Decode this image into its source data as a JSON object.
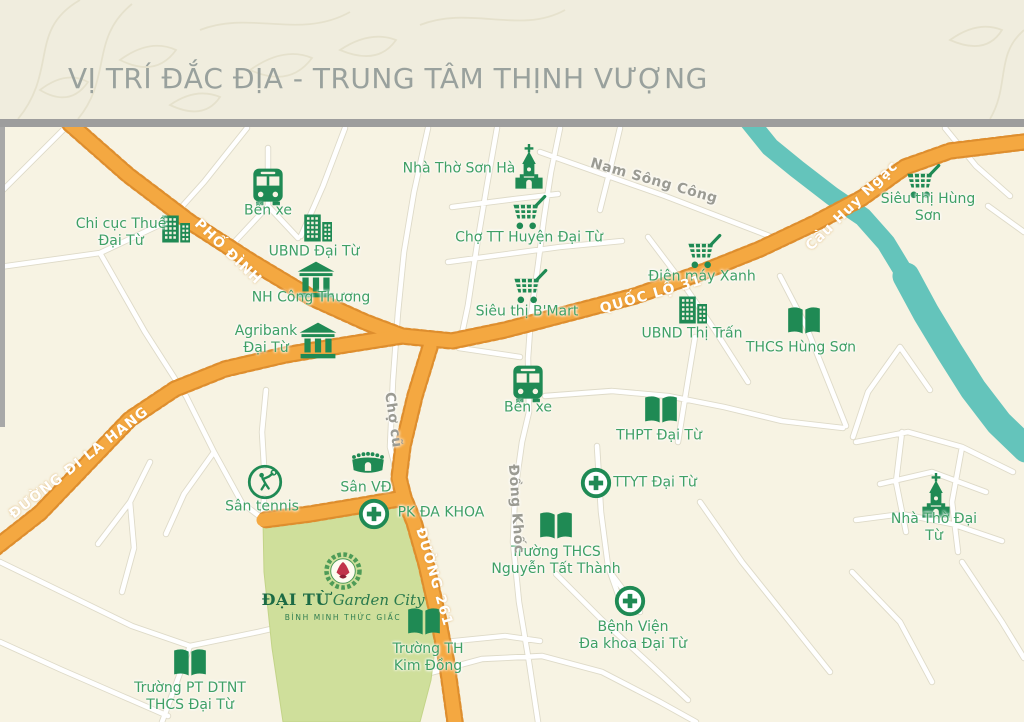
{
  "header": {
    "title": "VỊ TRÍ ĐẮC ĐỊA - TRUNG TÂM THỊNH VƯỢNG"
  },
  "colors": {
    "title_gray": "#99A19D",
    "road_orange": "#F4A841",
    "road_edge_orange": "#DE8E2E",
    "river_teal": "#64C4BB",
    "project_green": "#CFDF9B",
    "icon_green": "#1F8A54",
    "label_green": "#3FA066",
    "street_label_gray": "#9B9B93"
  },
  "map": {
    "pois": [
      {
        "id": "chi-cuc-thue",
        "icon": "building",
        "x": 175,
        "y": 229,
        "label": "Chi cục Thuế\nĐại Từ",
        "lx": 121,
        "ly": 233
      },
      {
        "id": "ben-xe-north",
        "icon": "bus",
        "x": 268,
        "y": 186,
        "label": "Bến xe",
        "lx": 268,
        "ly": 211
      },
      {
        "id": "ubnd-dai-tu",
        "icon": "building",
        "x": 317,
        "y": 228,
        "label": "UBND Đại Từ",
        "lx": 314,
        "ly": 252
      },
      {
        "id": "nha-tho-son-ha",
        "icon": "church",
        "x": 529,
        "y": 167,
        "label": "Nhà Thờ Sơn Hà",
        "lx": 459,
        "ly": 169
      },
      {
        "id": "cho-tt-huyen",
        "icon": "cart",
        "x": 529,
        "y": 213,
        "label": "Chợ TT Huyện Đại Từ",
        "lx": 529,
        "ly": 238
      },
      {
        "id": "sieu-thi-hung-son",
        "icon": "cart",
        "x": 923,
        "y": 182,
        "label": "Siêu thị Hùng Sơn",
        "lx": 928,
        "ly": 208
      },
      {
        "id": "nh-cong-thuong",
        "icon": "bank",
        "x": 316,
        "y": 279,
        "label": "NH Công Thương",
        "lx": 311,
        "ly": 298
      },
      {
        "id": "sieu-thi-bmart",
        "icon": "cart",
        "x": 530,
        "y": 287,
        "label": "Siêu thị B'Mart",
        "lx": 527,
        "ly": 312
      },
      {
        "id": "dien-may-xanh",
        "icon": "cart",
        "x": 704,
        "y": 252,
        "label": "Điện máy Xanh",
        "lx": 702,
        "ly": 277
      },
      {
        "id": "ubnd-thi-tran",
        "icon": "building",
        "x": 692,
        "y": 310,
        "label": "UBND Thị Trấn",
        "lx": 692,
        "ly": 334
      },
      {
        "id": "thcs-hung-son",
        "icon": "book",
        "x": 804,
        "y": 321,
        "label": "THCS Hùng Sơn",
        "lx": 801,
        "ly": 348
      },
      {
        "id": "agribank",
        "icon": "bank",
        "x": 318,
        "y": 340,
        "label": "Agribank\nĐại Từ",
        "lx": 266,
        "ly": 340
      },
      {
        "id": "ben-xe-center",
        "icon": "bus",
        "x": 528,
        "y": 383,
        "label": "Bến xe",
        "lx": 528,
        "ly": 408
      },
      {
        "id": "thpt-dai-tu",
        "icon": "book",
        "x": 661,
        "y": 410,
        "label": "THPT Đại Từ",
        "lx": 659,
        "ly": 436
      },
      {
        "id": "san-vd",
        "icon": "stadium",
        "x": 368,
        "y": 464,
        "label": "Sân VĐ",
        "lx": 366,
        "ly": 488
      },
      {
        "id": "san-tennis",
        "icon": "tennis",
        "x": 265,
        "y": 482,
        "label": "Sân tennis",
        "lx": 262,
        "ly": 507
      },
      {
        "id": "pk-da-khoa",
        "icon": "medcross",
        "x": 374,
        "y": 514,
        "label": "PK ĐA KHOA",
        "lx": 441,
        "ly": 513
      },
      {
        "id": "ttyt-dai-tu",
        "icon": "medcross",
        "x": 596,
        "y": 483,
        "label": "TTYT Đại Từ",
        "lx": 655,
        "ly": 483
      },
      {
        "id": "thcs-nguyen-tat-thanh",
        "icon": "book",
        "x": 556,
        "y": 526,
        "label": "Trường THCS\nNguyễn Tất Thành",
        "lx": 556,
        "ly": 561
      },
      {
        "id": "nha-tho-dai-tu",
        "icon": "church",
        "x": 936,
        "y": 496,
        "label": "Nhà Thờ Đại Từ",
        "lx": 934,
        "ly": 528
      },
      {
        "id": "th-kim-dong",
        "icon": "book",
        "x": 424,
        "y": 622,
        "label": "Trường TH\nKim Đồng",
        "lx": 428,
        "ly": 658
      },
      {
        "id": "benh-vien-da-khoa",
        "icon": "medcross",
        "x": 630,
        "y": 601,
        "label": "Bệnh Viện\nĐa khoa Đại Từ",
        "lx": 633,
        "ly": 636
      },
      {
        "id": "pt-dtnt-thcs",
        "icon": "book",
        "x": 190,
        "y": 663,
        "label": "Trường PT DTNT\nTHCS Đại Từ",
        "lx": 190,
        "ly": 697
      }
    ],
    "road_labels": [
      {
        "id": "pho-dinh",
        "text": "PHỐ ĐÌNH",
        "x": 228,
        "y": 252,
        "rot": 44,
        "style": "highway"
      },
      {
        "id": "quoc-lo-31",
        "text": "QUỐC LỘ 31",
        "x": 651,
        "y": 295,
        "rot": -16,
        "style": "highway"
      },
      {
        "id": "cau-huy-ngac",
        "text": "Cầu Huy Ngạc",
        "x": 852,
        "y": 206,
        "rot": -44,
        "style": "highway"
      },
      {
        "id": "duong-di-la-hang",
        "text": "ĐƯỜNG ĐI LA HANG",
        "x": 79,
        "y": 463,
        "rot": -38,
        "style": "highway"
      },
      {
        "id": "duong-261",
        "text": "ĐƯỜNG 261",
        "x": 434,
        "y": 577,
        "rot": 74,
        "style": "highway"
      },
      {
        "id": "nam-song-cong",
        "text": "Nam Sông Công",
        "x": 654,
        "y": 181,
        "rot": 16,
        "style": "street"
      },
      {
        "id": "cho-cu",
        "text": "Chợ cũ",
        "x": 393,
        "y": 420,
        "rot": 82,
        "style": "street"
      },
      {
        "id": "dong-khoc",
        "text": "Đồng Khốc",
        "x": 516,
        "y": 509,
        "rot": 86,
        "style": "street"
      }
    ],
    "project": {
      "name_main": "ĐẠI TỪ",
      "name_script": "Garden City",
      "tagline": "BÌNH MINH THỨC GIẤC"
    }
  }
}
